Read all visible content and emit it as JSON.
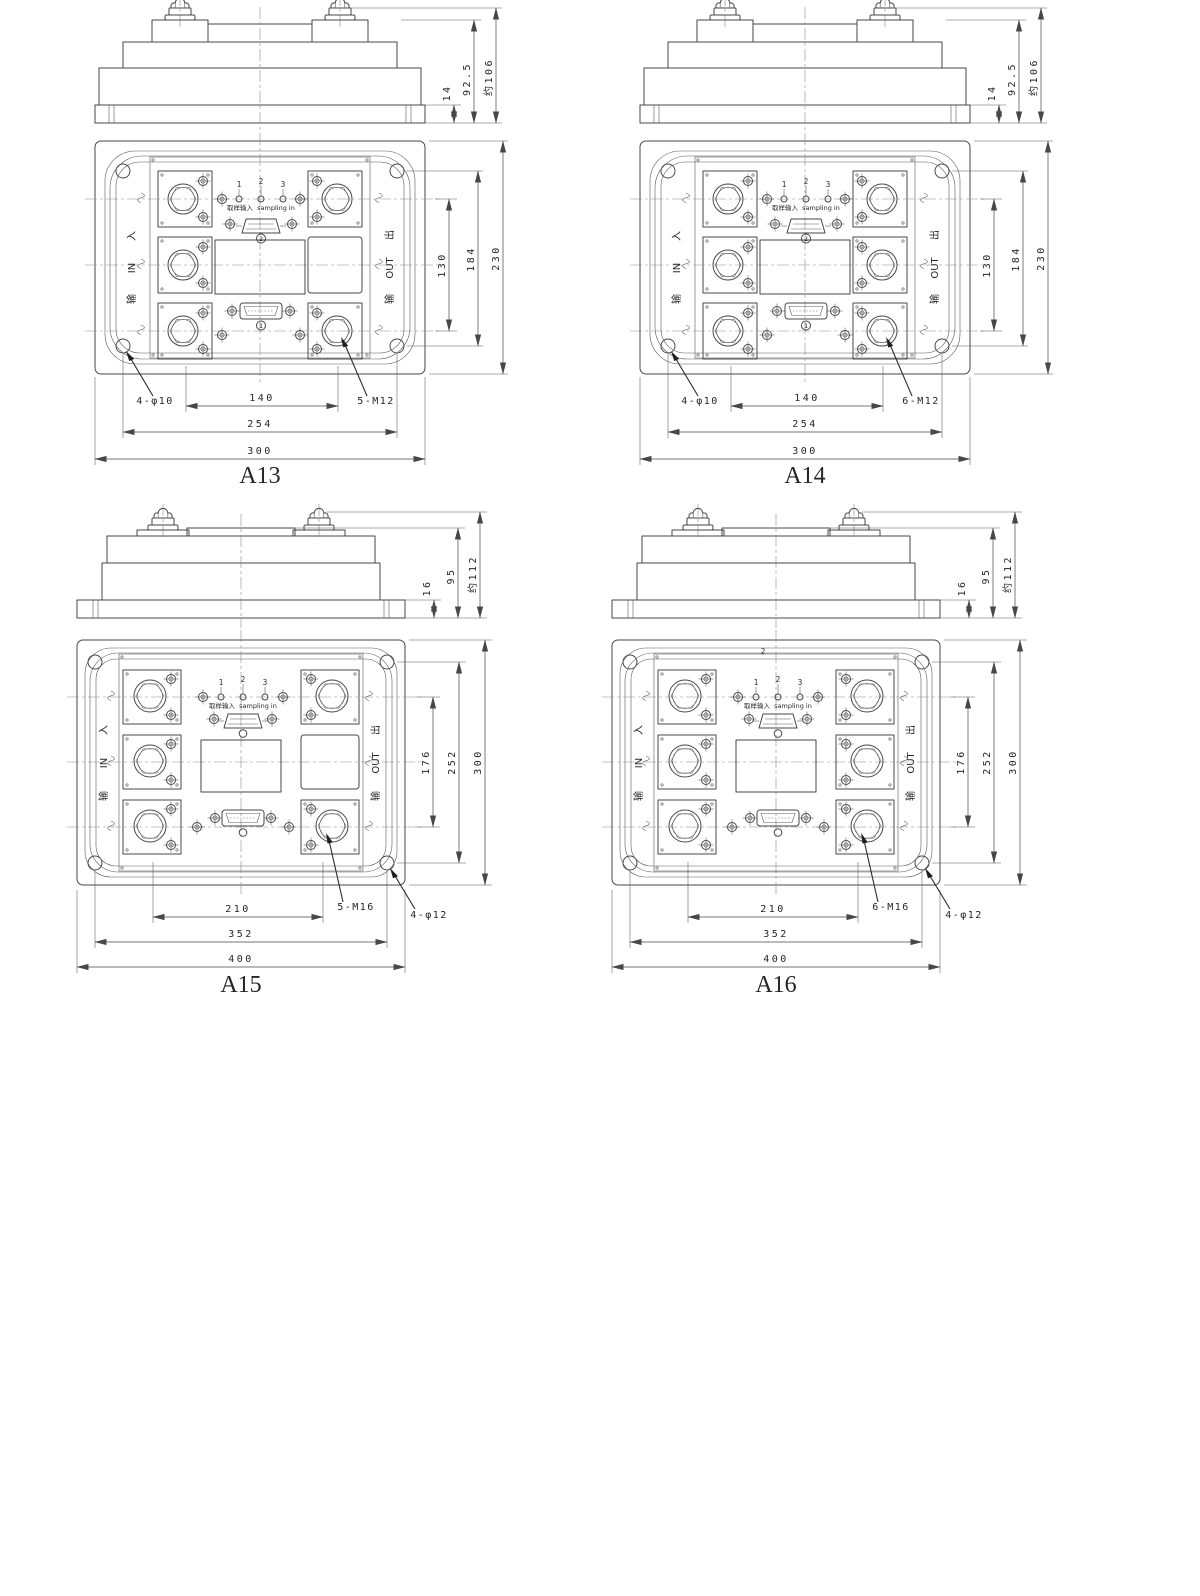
{
  "figure": {
    "type": "engineering-outline-drawings",
    "description": "Four module package outline drawings with dimensions",
    "line_color": "#474747",
    "background": "#ffffff"
  },
  "drawings": [
    {
      "title": "A13",
      "side": {
        "base_thickness": "14",
        "body_height": "92.5",
        "total_height": "约106"
      },
      "plan": {
        "v_inner": "130",
        "v_holes": "184",
        "v_overall": "230",
        "h_inner": "140",
        "h_holes": "254",
        "h_overall": "300"
      },
      "labels": {
        "mount_holes": "4-φ10",
        "terminals": "5-M12"
      },
      "pins": {
        "p1": "1",
        "p2": "2",
        "p3": "3"
      },
      "sampling": {
        "cn": "取样输入",
        "en": "sampling in"
      },
      "input": {
        "cn_char": "入",
        "en": "IN",
        "cn_word": "输"
      },
      "output": {
        "cn_char": "出",
        "en": "OUT",
        "cn_word": "输"
      },
      "connector_nums": {
        "top": "2",
        "bottom": "1"
      }
    },
    {
      "title": "A14",
      "side": {
        "base_thickness": "14",
        "body_height": "92.5",
        "total_height": "约106"
      },
      "plan": {
        "v_inner": "130",
        "v_holes": "184",
        "v_overall": "230",
        "h_inner": "140",
        "h_holes": "254",
        "h_overall": "300"
      },
      "labels": {
        "mount_holes": "4-φ10",
        "terminals": "6-M12"
      },
      "pins": {
        "p1": "1",
        "p2": "2",
        "p3": "3"
      },
      "sampling": {
        "cn": "取样输入",
        "en": "sampling in"
      },
      "input": {
        "cn_char": "入",
        "en": "IN",
        "cn_word": "输"
      },
      "output": {
        "cn_char": "出",
        "en": "OUT",
        "cn_word": "输"
      },
      "connector_nums": {
        "top": "2",
        "bottom": "1"
      }
    },
    {
      "title": "A15",
      "side": {
        "base_thickness": "16",
        "body_height": "95",
        "total_height": "约112"
      },
      "plan": {
        "v_inner": "176",
        "v_holes": "252",
        "v_overall": "300",
        "h_inner": "210",
        "h_holes": "352",
        "h_overall": "400"
      },
      "labels": {
        "mount_holes": "4-φ12",
        "terminals": "5-M16"
      },
      "pins": {
        "p1": "1",
        "p2": "2",
        "p3": "3"
      },
      "sampling": {
        "cn": "取样输入",
        "en": "sampling in"
      },
      "input": {
        "cn_char": "入",
        "en": "IN",
        "cn_word": "输"
      },
      "output": {
        "cn_char": "出",
        "en": "OUT",
        "cn_word": "输"
      }
    },
    {
      "title": "A16",
      "side": {
        "base_thickness": "16",
        "body_height": "95",
        "total_height": "约112"
      },
      "plan": {
        "v_inner": "176",
        "v_holes": "252",
        "v_overall": "300",
        "h_inner": "210",
        "h_holes": "352",
        "h_overall": "400"
      },
      "labels": {
        "mount_holes": "4-φ12",
        "terminals": "6-M16"
      },
      "pins": {
        "p1": "1",
        "p2": "2",
        "p3": "3"
      },
      "sampling": {
        "cn": "取样输入",
        "en": "sampling in"
      },
      "input": {
        "cn_char": "入",
        "en": "IN",
        "cn_word": "输"
      },
      "output": {
        "cn_char": "出",
        "en": "OUT",
        "cn_word": "输"
      },
      "extra_num": "2"
    }
  ]
}
